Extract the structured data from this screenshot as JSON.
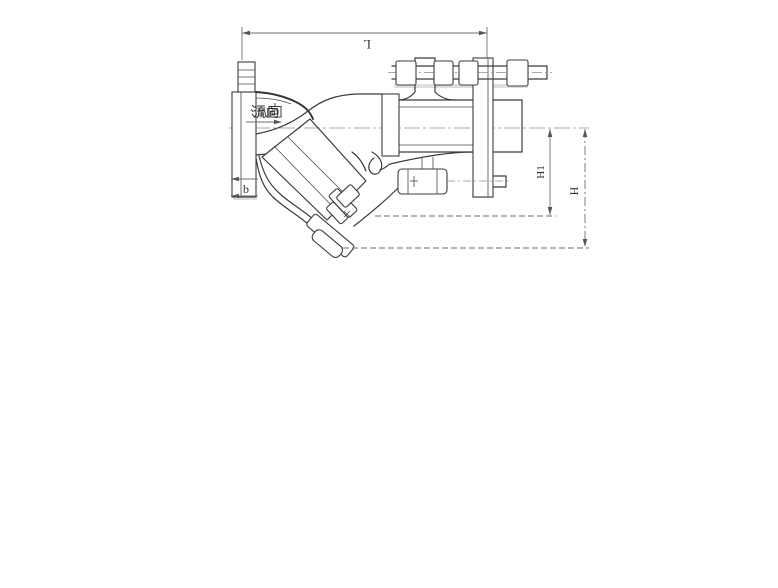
{
  "drawing": {
    "labels": {
      "flow": "流向",
      "length": "L",
      "height_total": "H",
      "height_partial": "H1",
      "flange_thickness": "b"
    },
    "colors": {
      "line": "#3c3c3c",
      "dimension": "#6a6e72",
      "background": "#ffffff"
    }
  }
}
